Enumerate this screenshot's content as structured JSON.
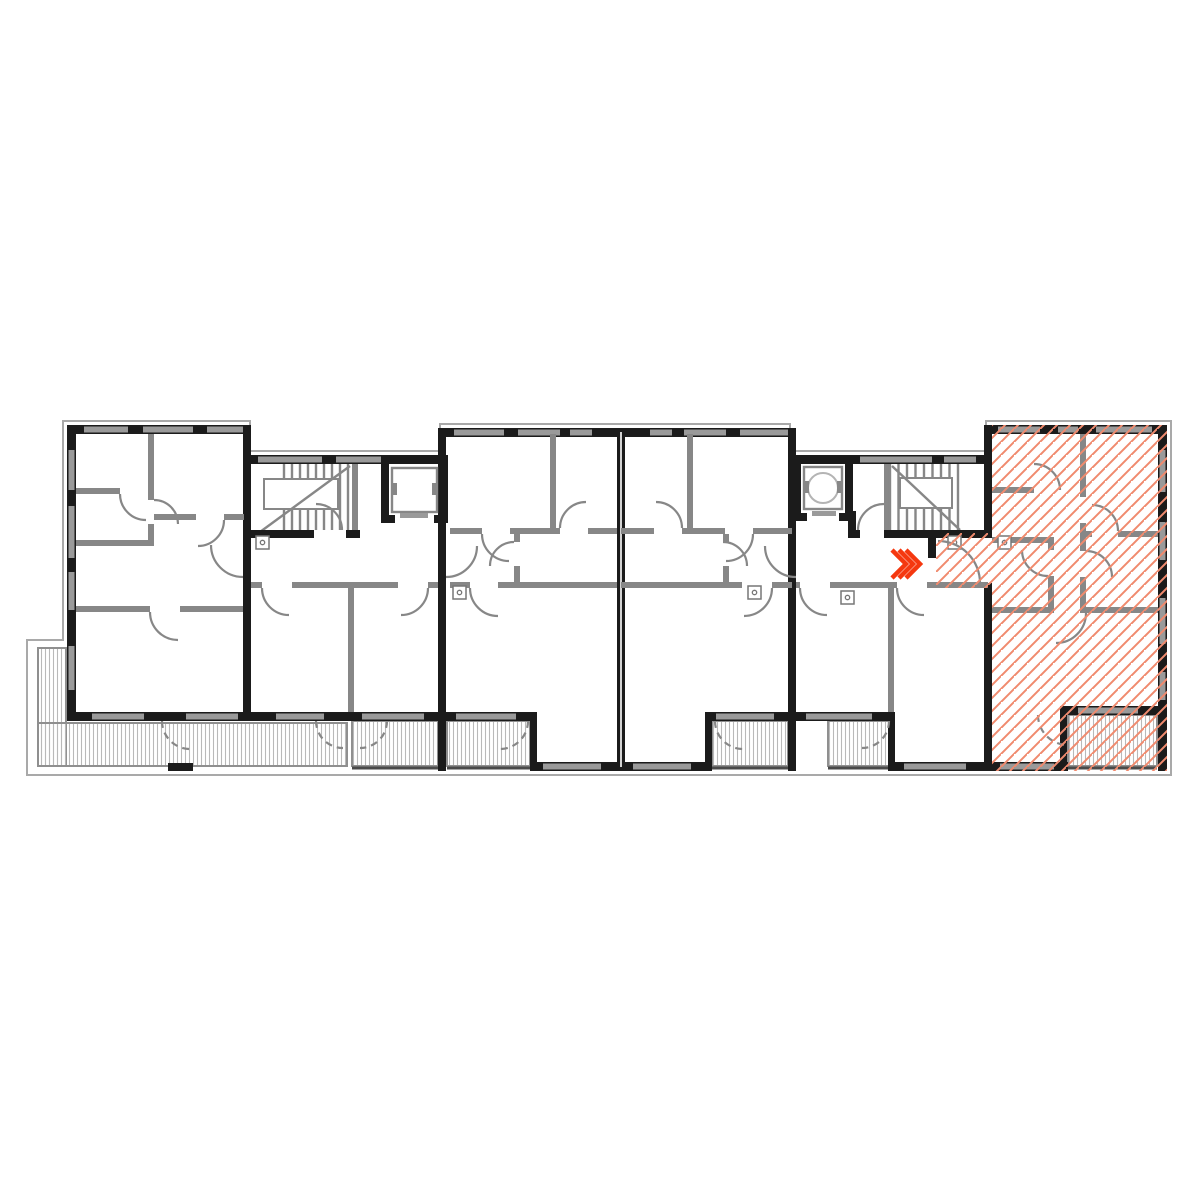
{
  "page": {
    "title": "Floor plan – selected apartment"
  },
  "plan": {
    "aria_label": "Architectural floor plan of an apartment building; the apartment at the right end is highlighted with red diagonal hatching and a red chevron arrow marks its entrance",
    "type": "residential-floor-plan",
    "selected_unit": {
      "id": "unit-east",
      "position": "east-end",
      "state": "selected",
      "fill_pattern": "diagonal-red-hatch",
      "includes_entry_corridor": true
    },
    "entrance_marker": {
      "type": "triple-chevron-arrow",
      "direction": "right",
      "color": "#f5380f"
    },
    "cores": [
      {
        "id": "west-core",
        "staircase": true,
        "elevator": true
      },
      {
        "id": "east-core",
        "staircase": true,
        "elevator": true,
        "elevator_turning_circle": true
      }
    ],
    "units": [
      {
        "id": "unit-west-end",
        "position": "west-end",
        "highlighted": false,
        "outdoor_area": "terrace"
      },
      {
        "id": "unit-west-core-south",
        "position": "south-of-west-core",
        "highlighted": false,
        "outdoor_area": "balcony"
      },
      {
        "id": "unit-center-west",
        "position": "center-west",
        "highlighted": false,
        "outdoor_area": "balcony"
      },
      {
        "id": "unit-center-east",
        "position": "center-east",
        "highlighted": false,
        "outdoor_area": "balcony"
      },
      {
        "id": "unit-east-core-south",
        "position": "south-of-east-core",
        "highlighted": false,
        "outdoor_area": "balcony"
      },
      {
        "id": "unit-east",
        "position": "east-end",
        "highlighted": true,
        "outdoor_area": "balcony"
      }
    ],
    "outdoor_areas": [
      {
        "id": "west-terrace",
        "shape": "L",
        "hatch": "vertical-stripes"
      },
      {
        "id": "balcony-west-core",
        "hatch": "vertical-stripes"
      },
      {
        "id": "balcony-center-west",
        "hatch": "vertical-stripes"
      },
      {
        "id": "balcony-center-east",
        "hatch": "vertical-stripes"
      },
      {
        "id": "balcony-east-core",
        "hatch": "vertical-stripes"
      },
      {
        "id": "balcony-east",
        "hatch": "vertical-stripes"
      }
    ],
    "colors": {
      "background": "#ffffff",
      "wall_dark": "#1b1b1b",
      "wall_gray": "#878787",
      "wall_light": "#b4b4b4",
      "window_fill": "#9a9a9a",
      "outline": "#a9a9a9",
      "deck_stripe": "#b9b9b9",
      "deck_border": "#8f8f8f",
      "hatch_red": "#f08a6e",
      "arrow_red": "#f5380f",
      "icon_gray": "#777777"
    }
  }
}
